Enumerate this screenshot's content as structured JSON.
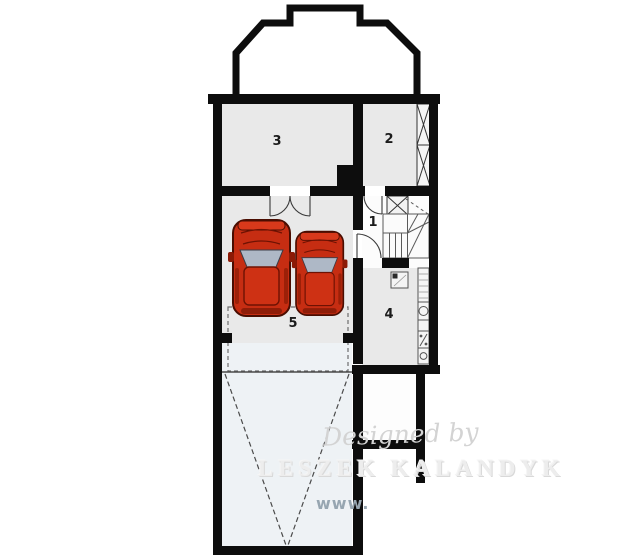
{
  "rooms": [
    {
      "number": "1"
    },
    {
      "number": "2"
    },
    {
      "number": "3"
    },
    {
      "number": "4"
    },
    {
      "number": "5"
    }
  ],
  "watermark": {
    "script": "Designed by",
    "name": "LESZEK KALANDYK",
    "url": "www."
  },
  "colors": {
    "wall": "#0d0d0d",
    "room": "#e9e9e9",
    "drive": "#eef2f5",
    "car": "#c62d12",
    "glass": "#aeb8c6"
  },
  "icons": {
    "stairs": "stair-treads",
    "chimney": "x-hatched-shaft",
    "wall_hatch": "x-hatched-wall-strip",
    "double_door": "double-swing-arcs",
    "door": "quarter-arc",
    "ramp": "dashed-v-ramp",
    "cars": "top-view-car"
  }
}
